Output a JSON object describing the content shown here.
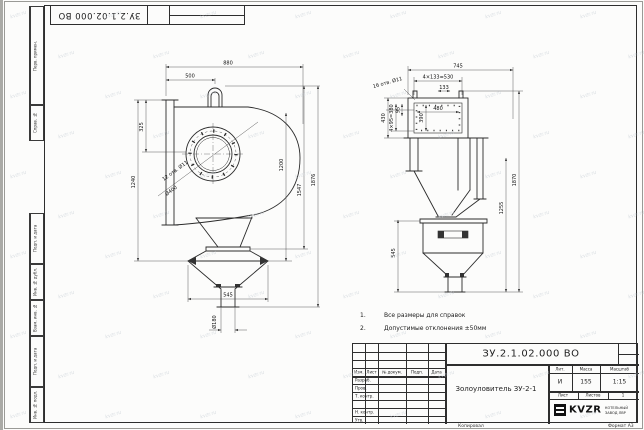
{
  "frame": {
    "margin_labels": [
      "Перв. примен.",
      "Справ. №",
      "Подп. и дата",
      "Инв. № дубл.",
      "Взам. инв. №",
      "Подп. и дата",
      "Инв. № подл."
    ],
    "doc_number_rotated": "ЗУ.2.1.02.000 ВО",
    "copied": "Копировал",
    "format": "Формат А3"
  },
  "notes": {
    "n1": "1.",
    "t1": "Все размеры для справок",
    "n2": "2.",
    "t2": "Допустимые отклонения ±50мм"
  },
  "dims": {
    "front": {
      "w880": "880",
      "w500": "500",
      "h325": "325",
      "h1240": "1240",
      "holes": "12 отв. Ø11",
      "bore": "Ø400",
      "outlet": "Ø180",
      "w545": "545",
      "h1200": "1200",
      "h1547": "1547",
      "h1876": "1876"
    },
    "side": {
      "d745": "745",
      "pitch_row": "4×133=530",
      "p133": "133",
      "w480": "480",
      "h390": "390",
      "p95": "95",
      "pitch_col": "4×95=380",
      "h430": "430",
      "holes": "16 отв. Ø11",
      "h545": "545",
      "h1255": "1255",
      "h1870": "1870"
    }
  },
  "titleblock": {
    "doc_number": "ЗУ.2.1.02.000 ВО",
    "name": "Золоуловитель ЗУ-2-1",
    "header": [
      "Изм.",
      "Лист",
      "№ докум.",
      "Подп.",
      "Дата"
    ],
    "rows": [
      "Разраб.",
      "Пров.",
      "Т. контр.",
      "",
      "Н. контр.",
      "Утв."
    ],
    "lit_label": "Лит.",
    "mass_label": "Масса",
    "scale_label": "Масштаб",
    "lit": "И",
    "mass": "155",
    "scale": "1:15",
    "sheet_label": "Лист",
    "sheets_label": "Листов",
    "sheets": "1",
    "company_logo": "KVZR",
    "company_line1": "КОТЕЛЬНЫЙ",
    "company_line2": "ЗАВОД ЛВР"
  },
  "watermark": "kvzr.ru",
  "colors": {
    "line": "#2b2b2b",
    "dim": "#4a4a4a",
    "paper": "#fcfcfb"
  }
}
